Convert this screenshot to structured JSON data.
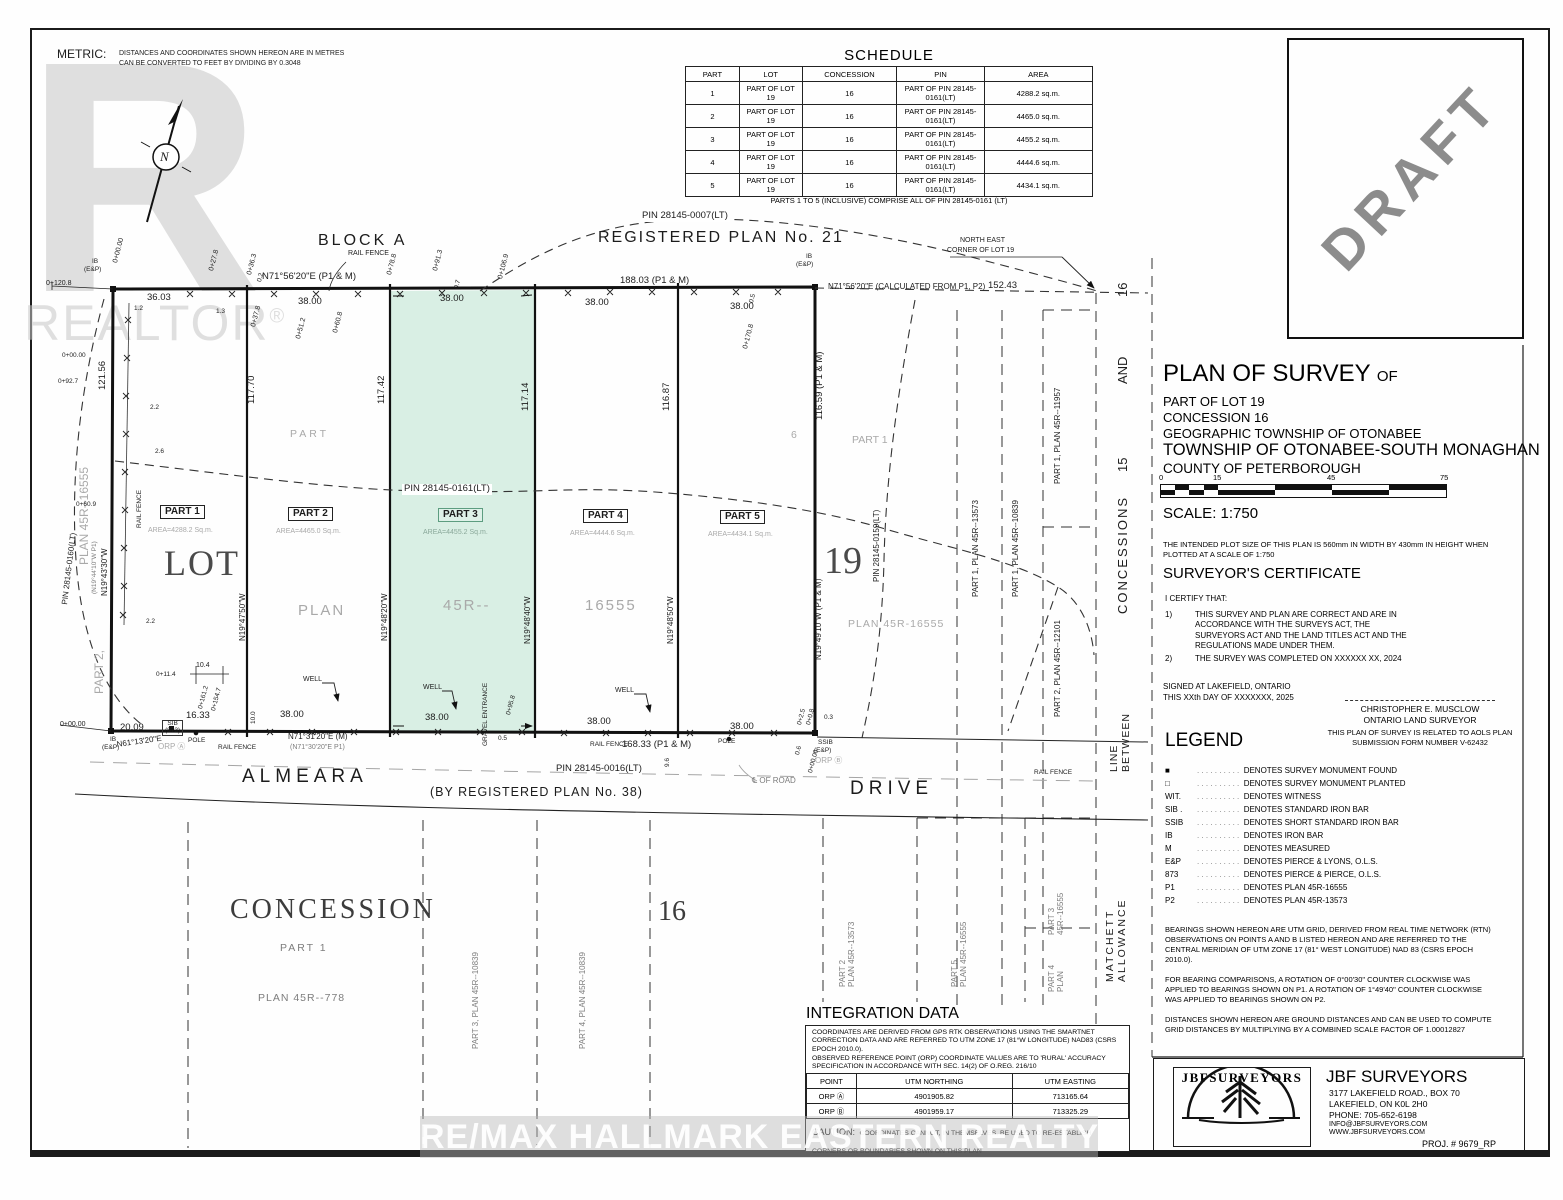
{
  "metric": {
    "label": "METRIC:",
    "line1": "DISTANCES AND COORDINATES SHOWN HEREON ARE IN METRES",
    "line2": "CAN BE CONVERTED TO FEET BY DIVIDING BY 0.3048"
  },
  "watermarks": {
    "realtor_r": "R",
    "realtor": "REALTOR",
    "reg": "®",
    "remax": "RE/MAX HALLMARK EASTERN REALTY Brokerage",
    "draft": "DRAFT",
    "north_n": "N"
  },
  "schedule": {
    "title": "SCHEDULE",
    "headers": [
      "PART",
      "LOT",
      "CONCESSION",
      "PIN",
      "AREA"
    ],
    "rows": [
      [
        "1",
        "PART OF LOT 19",
        "16",
        "PART OF PIN 28145-0161(LT)",
        "4288.2 sq.m."
      ],
      [
        "2",
        "PART OF LOT 19",
        "16",
        "PART OF PIN 28145-0161(LT)",
        "4465.0 sq.m."
      ],
      [
        "3",
        "PART OF LOT 19",
        "16",
        "PART OF PIN 28145-0161(LT)",
        "4455.2 sq.m."
      ],
      [
        "4",
        "PART OF LOT 19",
        "16",
        "PART OF PIN 28145-0161(LT)",
        "4444.6 sq.m."
      ],
      [
        "5",
        "PART OF LOT 19",
        "16",
        "PART OF PIN 28145-0161(LT)",
        "4434.1 sq.m."
      ]
    ],
    "footer": "PARTS 1 TO 5 (INCLUSIVE) COMPRISE ALL OF PIN 28145-0161 (LT)"
  },
  "title_block": {
    "title": "PLAN OF SURVEY",
    "title_of": "OF",
    "line1": "PART OF LOT 19",
    "line2": "CONCESSION 16",
    "line3": "GEOGRAPHIC TOWNSHIP OF OTONABEE",
    "line4": "TOWNSHIP OF OTONABEE-SOUTH MONAGHAN",
    "line5": "COUNTY OF PETERBOROUGH",
    "scale_ticks": [
      "0",
      "15",
      "45",
      "75"
    ],
    "scale_label": "SCALE:  1:750",
    "plot_note": "THE INTENDED PLOT SIZE OF THIS PLAN IS 560mm IN WIDTH BY 430mm IN HEIGHT WHEN PLOTTED AT A SCALE OF 1:750",
    "cert_title": "SURVEYOR'S CERTIFICATE",
    "cert_intro": "I CERTIFY THAT:",
    "cert1_num": "1)",
    "cert1": "THIS SURVEY AND PLAN ARE CORRECT AND ARE IN ACCORDANCE WITH THE SURVEYS ACT, THE SURVEYORS ACT AND THE LAND TITLES ACT AND THE REGULATIONS MADE UNDER THEM.",
    "cert2_num": "2)",
    "cert2": "THE SURVEY WAS COMPLETED ON XXXXXX  XX, 2024",
    "signed1": "SIGNED AT LAKEFIELD, ONTARIO",
    "signed2": "THIS XXth DAY OF XXXXXXX, 2025",
    "surveyor": "CHRISTOPHER E. MUSCLOW",
    "surveyor_title": "ONTARIO LAND SURVEYOR",
    "aols": "THIS PLAN OF SURVEY IS RELATED TO AOLS PLAN SUBMISSION FORM NUMBER V-62432",
    "legend_title": "LEGEND",
    "legend_dots": ". . . . . . . . . .",
    "legend": [
      {
        "sym": "■",
        "text": "DENOTES SURVEY MONUMENT FOUND"
      },
      {
        "sym": "□",
        "text": "DENOTES SURVEY MONUMENT PLANTED"
      },
      {
        "sym": "WIT.",
        "text": "DENOTES WITNESS"
      },
      {
        "sym": "SIB .",
        "text": "DENOTES STANDARD IRON BAR"
      },
      {
        "sym": "SSIB",
        "text": "DENOTES SHORT STANDARD IRON BAR"
      },
      {
        "sym": "IB",
        "text": "DENOTES IRON BAR"
      },
      {
        "sym": "M",
        "text": "DENOTES MEASURED"
      },
      {
        "sym": "E&P",
        "text": "DENOTES PIERCE & LYONS, O.L.S."
      },
      {
        "sym": "873",
        "text": "DENOTES PIERCE & PIERCE, O.L.S."
      },
      {
        "sym": "P1",
        "text": "DENOTES  PLAN 45R-16555"
      },
      {
        "sym": "P2",
        "text": "DENOTES PLAN 45R-13573"
      }
    ],
    "note1": "BEARINGS SHOWN HEREON ARE UTM GRID, DERIVED FROM REAL TIME NETWORK (RTN) OBSERVATIONS ON POINTS A AND B LISTED HEREON AND ARE REFERRED TO THE CENTRAL MERIDIAN OF UTM ZONE 17 (81° WEST LONGITUDE) NAD 83 (CSRS EPOCH 2010.0).",
    "note2": "FOR BEARING COMPARISONS, A ROTATION OF 0°00'30\" COUNTER CLOCKWISE WAS APPLIED TO BEARINGS SHOWN ON P1. A ROTATION OF 1°49'40\" COUNTER CLOCKWISE WAS APPLIED TO BEARINGS SHOWN ON P2.",
    "note3": "DISTANCES SHOWN HEREON ARE GROUND DISTANCES AND CAN BE USED TO COMPUTE GRID DISTANCES BY MULTIPLYING BY A COMBINED SCALE FACTOR OF 1.00012827"
  },
  "integration": {
    "title": "INTEGRATION DATA",
    "para1": "COORDINATES ARE DERIVED FROM GPS RTK OBSERVATIONS USING THE SMARTNET CORRECTION DATA AND ARE REFERRED TO UTM ZONE 17 (81°W LONGITUDE) NAD83 (CSRS EPOCH 2010.0).",
    "para2": "OBSERVED REFERENCE POINT (ORP) COORDINATE VALUES ARE TO 'RURAL' ACCURACY SPECIFICATION IN ACCORDANCE WITH SEC. 14(2) OF O.REG. 216/10",
    "headers": [
      "POINT",
      "UTM NORTHING",
      "UTM EASTING"
    ],
    "rows": [
      [
        "ORP Ⓐ",
        "4901905.82",
        "713165.64"
      ],
      [
        "ORP Ⓑ",
        "4901959.17",
        "713325.29"
      ]
    ],
    "caution_label": "CAUTION:",
    "caution": "COORDINATES CANNOT, IN THEMSELVES, BE USED TO RE-ESTABLISH CORNERS OR BOUNDARIES SHOWN ON THIS PLAN"
  },
  "jbf": {
    "name": "JBF SURVEYORS",
    "addr1": "3177 LAKEFIELD ROAD., BOX 70",
    "addr2": "LAKEFIELD,  ON    K0L 2H0",
    "phone": "PHONE:  705-652-6198",
    "email": "INFO@JBFSURVEYORS.COM",
    "web": "WWW.JBFSURVEYORS.COM",
    "proj": "PROJ. # 9679_RP",
    "logo_text": "JBFSURVEYORS"
  },
  "map": {
    "block_a": "BLOCK  A",
    "reg21": "REGISTERED  PLAN  No.  21",
    "pin0007": "PIN 28145-0007(LT)",
    "pin0161": "PIN 28145-0161(LT)",
    "pin0160": "PIN 28145-0160(LT)",
    "pin0159": "PIN  28145-0159(LT)",
    "pin0016": "PIN  28145-0016(LT)",
    "ne1": "NORTH  EAST",
    "ne2": "CORNER  OF  LOT  19",
    "brg_top": "N71°56'20\"E (P1 & M)",
    "brg_calc": "N71°56'20\"E  (CALCULATED FROM P1, P2)",
    "d18803": "188.03 (P1 & M)",
    "d15243": "152.43",
    "d3603": "36.03",
    "d38": "38.00",
    "d1633": "16.33",
    "d16833": "168.33 (P1 & M)",
    "d2009": "20.09",
    "d12156": "121.56",
    "d11770": "117.70",
    "d11742": "117.42",
    "d11714": "117.14",
    "d11687": "116.87",
    "d11659": "116.59 (P1 & M)",
    "brg1": "N19°47'50\"W",
    "brg2": "N19°48'20\"W",
    "brg3": "N19°48'40\"W",
    "brg4": "N19°48'50\"W",
    "brg5": "N19°49'10\"W (P1 & M)",
    "brgl1": "(N19°44'10\"W P1)",
    "brgl2": "N19°43'30\"W",
    "brgn61": "N61°13'20\"E",
    "brgbot": "N71°31'20\"E (M)",
    "brgbot2": "(N71°30'20\"E  P1)",
    "ib": "IB",
    "eandp": "(E&P)",
    "ssib": "SSIB",
    "sib": "SIB",
    "n873": "(873)",
    "orpa": "ORP Ⓐ",
    "orpb": "ORP Ⓑ",
    "pole": "POLE",
    "rail": "RAIL FENCE",
    "well": "WELL",
    "gravel": "GRAVEL ENTRANCE",
    "part1": "PART 1",
    "part2": "PART 2",
    "part3": "PART 3",
    "part4": "PART 4",
    "part5": "PART 5",
    "area1": "AREA=4288.2   Sq.m.",
    "area2": "AREA=4465.0   Sq.m.",
    "area3": "AREA=4455.2   Sq.m.",
    "area4": "AREA=4444.6   Sq.m.",
    "area5": "AREA=4434.1   Sq.m.",
    "lot": "LOT",
    "n19": "19",
    "gplan": "PLAN",
    "g45r": "45R--",
    "g16555": "16555",
    "gpart": "PART",
    "g6": "6",
    "gpart1": "PART 1",
    "gplanr": "PLAN  45R-16555",
    "gpart2l": "PART 2,",
    "gplanl": "PLAN 45R--16555",
    "v13573": "PART 1,  PLAN  45R--13573",
    "v10839": "PART 1,  PLAN  45R--10839",
    "v11957": "PART 1,  PLAN  45R--11957",
    "v12101": "PART 2,  PLAN  45R--12101",
    "almeara": "ALMEARA",
    "drive": "DRIVE",
    "byreg": "(BY  REGISTERED  PLAN  No.  38)",
    "clroad": "℄ OF ROAD",
    "concession": "CONCESSION",
    "n16": "16",
    "part1b": "PART  1",
    "plan778": "PLAN  45R--778",
    "v10839a": "PART 3,  PLAN  45R--10839",
    "v10839b": "PART 4,  PLAN  45R--10839",
    "p2a": "PART 2",
    "p2b": "PLAN 45R--13573",
    "p5a": "PART 5",
    "p5b": "PLAN  45R--16555",
    "p3a": "PART 3",
    "p3b": "45R--16555",
    "p4a": "PART 4",
    "p4b": "PLAN",
    "matchett1": "MATCHETT",
    "matchett2": "ALLOWANCE",
    "roadv": "ROAD",
    "linev": "LINE",
    "betweenv": "BETWEEN",
    "concv": "CONCESSIONS",
    "n15v": "15",
    "andv": "AND",
    "n16v": "16",
    "d96": "9.6",
    "d100": "10.0",
    "d104": "10.4",
    "ch114": "0+11.4",
    "ch1612": "0+161.2",
    "ch1547": "0+154.7",
    "ch958": "0+95.8",
    "ch00": "0+00.00",
    "ch1208": "0+120.8",
    "ch278": "0+27.8",
    "ch363": "0+36.3",
    "ch378": "0+37.8",
    "ch512": "0+51.2",
    "ch608": "0+60.8",
    "ch788": "0+78.8",
    "ch913": "0+91.3",
    "ch1069": "0+106.9",
    "ch1708": "0+170.8",
    "ch927": "0+92.7",
    "ch609": "0+60.9",
    "ch25": "0+2.5",
    "ch08": "0+0.8",
    "o12": "1.2",
    "o13": "1.3",
    "o22": "2.2",
    "o26": "2.6",
    "o03": "0.3",
    "o06": "0.6",
    "o05": "0.5",
    "o07": "0.7",
    "o02": "0.2"
  }
}
